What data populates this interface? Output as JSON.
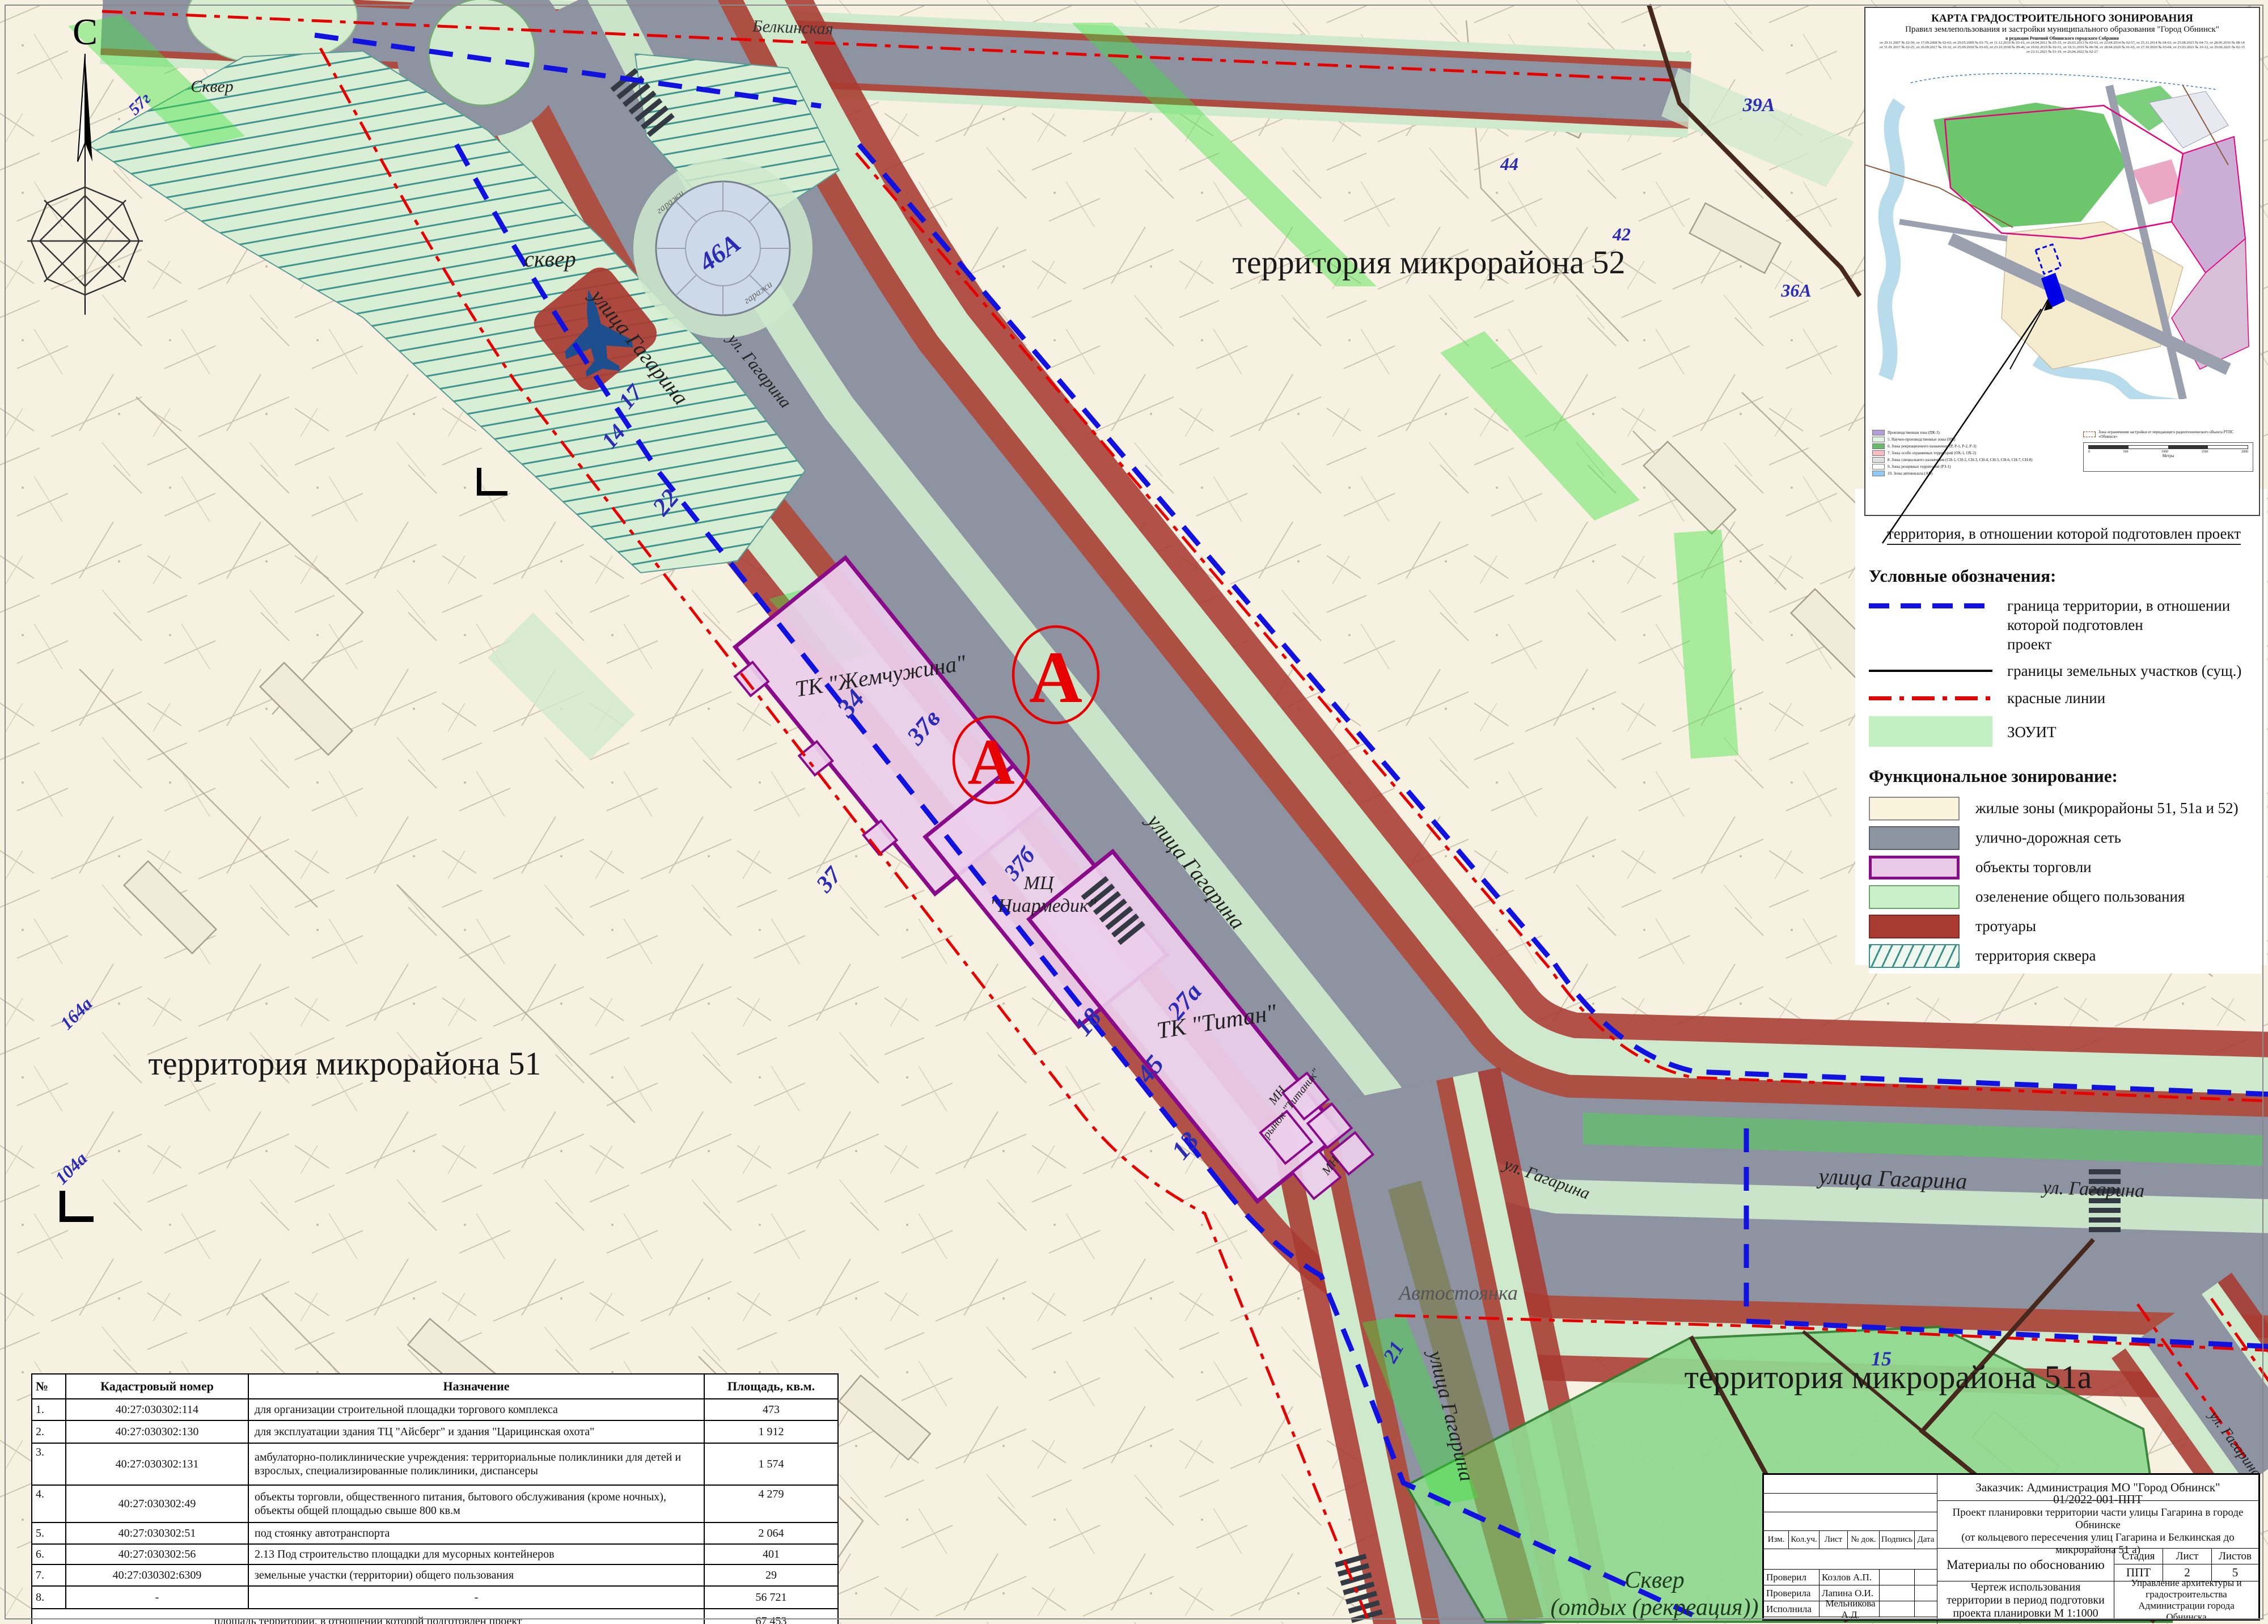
{
  "compass": {
    "north": "С"
  },
  "map": {
    "territories": {
      "d52": "территория микрорайона 52",
      "d51": "территория микрорайона 51",
      "d51a": "территория микрорайона 51а"
    },
    "streets": {
      "gagarina_full": "улица Гагарина",
      "gagarina_short": "ул. Гагарина",
      "belkinskaya": "Белкинская"
    },
    "places": {
      "skver_small": "сквер",
      "skver_top": "Сквер",
      "skver_rec_1": "Сквер",
      "skver_rec_2": "(отдых (рекреация))",
      "parking": "Автостоянка",
      "garages": "гаражи",
      "market": "рынок \"Титаник\"",
      "mn": "МН"
    },
    "buildings": {
      "zhemchuzhina": "ТК \"Жемчужина\"",
      "zhemchuzhina_num": "37в",
      "niarmedik_1": "МЦ",
      "niarmedik_2": "\"Ниармедик\"",
      "niarmedik_num": "37б",
      "titan": "ТК \"Титан\"",
      "titan_num": "27а",
      "garage_num": "46А",
      "marker_a": "А"
    },
    "parcels": [
      "34",
      "22",
      "17",
      "14",
      "18",
      "45",
      "13",
      "15",
      "37",
      "39А",
      "44",
      "42",
      "28",
      "30",
      "36А",
      "40",
      "21",
      "57г",
      "164а",
      "104а"
    ]
  },
  "legend": {
    "title": "Условные обозначения:",
    "boundary1": "граница территории, в отношении которой подготовлен",
    "boundary2": "проект",
    "land": "границы земельных участков (сущ.)",
    "redlines": "красные линии",
    "zouit": "ЗОУИТ",
    "zoning_title": "Функциональное зонирование:",
    "z1": "жилые зоны (микрорайоны 51, 51а и 52)",
    "z2": "улично-дорожная сеть",
    "z3": "объекты торговли",
    "z4": "озеленение общего пользования",
    "z5": "тротуары",
    "z6": "территория сквера"
  },
  "inset": {
    "title1": "КАРТА ГРАДОСТРОИТЕЛЬНОГО ЗОНИРОВАНИЯ",
    "title2": "Правил землепользования и застройки муниципального образования \"Город Обнинск\"",
    "title3": "в редакции Решений Обнинского городского Собрания",
    "amendments1": "от 29.11.2007 № 02-50, от 17.09.2008 № 02-63, от 29.05.2009 № 03-75, от 11.12.2010 № 03-16, от 24.04.2012 № 05-33, от 26.03.2013 № 02-63, от 22.04.2014 № 02-57, от 25.11.2014 № 04-63, от 25.08.2015 № 04-73, от 28.06.2016 № 08-14",
    "amendments2": "от 31.01.2017 № 02-25, от 26.09.2017 № 10-32, от 25.09.2018 № 03-65, от 23.10.2018 № 09-46, от 19.02.2019 № 02-51, от 19.11.2019 № 06-58, от 28.04.2020 № 01-65, от 27.10.2020 № 03-04, от 23.03.2021 № 10-12, от 29.06.2021 № 02-15",
    "amendments3": "от 23.11.2021 № 01-19, от 26.04.2022 № 02-27",
    "caption": "территория, в отношении которой подготовлен проект",
    "legend_items": [
      "Производственная зона (ПК-3)",
      "5. Научно-производственные зоны (НП)",
      "6. Зоны рекреационного назначения (Р, Р-1, Р-2, Р-3)",
      "7. Зоны особо охраняемых территорий (ОХ-1, ОХ-2)",
      "8. Зоны специального назначения (СН-1, СН-2, СН-3, СН-4, СН-5, СН-6, СН-7, СН-8)",
      "9. Зоны резервных территорий (РЗ-1)",
      "10. Зоны автовокзала (АВ)"
    ],
    "rtps": "Зона ограничения застройки от передающего радиотехнического объекта РТПС «Обнинск»",
    "scale_label": "Метры",
    "scale_ticks": [
      "0",
      "500",
      "1000",
      "1500",
      "2000"
    ]
  },
  "table": {
    "headers": [
      "№",
      "Кадастровый номер",
      "Назначение",
      "Площадь, кв.м."
    ],
    "rows": [
      [
        "1.",
        "40:27:030302:114",
        "для организации строительной площадки торгового комплекса",
        "473"
      ],
      [
        "2.",
        "40:27:030302:130",
        "для эксплуатации здания ТЦ \"Айсберг\" и здания \"Царицинская охота\"",
        "1 912"
      ],
      [
        "3.",
        "40:27:030302:131",
        "амбулаторно-поликлинические учреждения: территориальные поликлиники для детей и взрослых, специализированные поликлиники, диспансеры",
        "1 574"
      ],
      [
        "4.",
        "40:27:030302:49",
        "объекты торговли, общественного питания, бытового обслуживания (кроме ночных), объекты общей площадью свыше 800 кв.м",
        "4 279"
      ],
      [
        "5.",
        "40:27:030302:51",
        "под стоянку автотранспорта",
        "2 064"
      ],
      [
        "6.",
        "40:27:030302:56",
        "2.13 Под строительство площадки для мусорных контейнеров",
        "401"
      ],
      [
        "7.",
        "40:27:030302:6309",
        "земельные участки (территории) общего пользования",
        "29"
      ],
      [
        "8.",
        "-",
        "-",
        "56 721"
      ]
    ],
    "footer": {
      "label": "площадь территории, в отношении которой подготовлен проект",
      "value": "67 453"
    }
  },
  "titleblock": {
    "customer": "Заказчик: Администрация МО \"Город Обнинск\"",
    "code": "01/2022-001-ППТ",
    "project_line1": "Проект планировки территории части улицы Гагарина в городе Обнинске",
    "project_line2": "(от кольцевого пересечения улиц Гагарина и Белкинская до микрорайона 51 а)",
    "columns": [
      "Изм.",
      "Кол.уч.",
      "Лист",
      "№ док.",
      "Подпись",
      "Дата"
    ],
    "materials": "Материалы по обоснованию",
    "stage_label": "Стадия",
    "sheet_label": "Лист",
    "sheets_label": "Листов",
    "stage": "ППТ",
    "sheet": "2",
    "sheets": "5",
    "roles": [
      {
        "label": "Проверил",
        "name": "Козлов А.П."
      },
      {
        "label": "Проверила",
        "name": "Лапина О.И."
      },
      {
        "label": "Исполнила",
        "name": "Мельникова А.Д."
      }
    ],
    "drawing_title": "Чертеж использования территории в период подготовки проекта планировки М 1:1000",
    "org": "Управление архитектуры и градостроительства Администрации города Обнинска"
  }
}
